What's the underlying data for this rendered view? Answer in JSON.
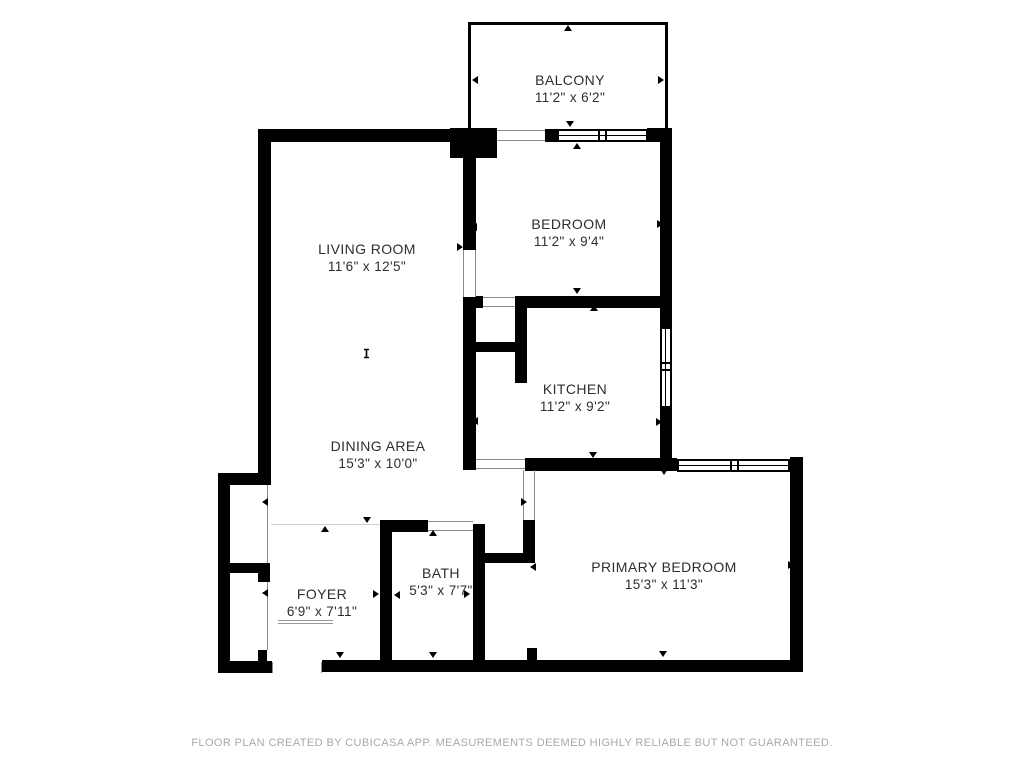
{
  "title": "Floor plan",
  "rooms": [
    {
      "id": "balcony",
      "name": "BALCONY",
      "dims": "11'2\" x 6'2\""
    },
    {
      "id": "bedroom",
      "name": "BEDROOM",
      "dims": "11'2\" x 9'4\""
    },
    {
      "id": "living-room",
      "name": "LIVING ROOM",
      "dims": "11'6\" x 12'5\""
    },
    {
      "id": "kitchen",
      "name": "KITCHEN",
      "dims": "11'2\" x 9'2\""
    },
    {
      "id": "dining-area",
      "name": "DINING AREA",
      "dims": "15'3\" x 10'0\""
    },
    {
      "id": "foyer",
      "name": "FOYER",
      "dims": "6'9\" x 7'11\""
    },
    {
      "id": "bath",
      "name": "BATH",
      "dims": "5'3\" x 7'7\""
    },
    {
      "id": "primary-bedroom",
      "name": "PRIMARY BEDROOM",
      "dims": "15'3\" x 11'3\""
    }
  ],
  "footer": {
    "disclaimer": "FLOOR PLAN CREATED BY CUBICASA APP. MEASUREMENTS DEEMED HIGHLY RELIABLE BUT NOT GUARANTEED."
  },
  "colors": {
    "wall": "#000000",
    "label": "#2e2e2e",
    "footer_text": "#a9a9a9"
  }
}
